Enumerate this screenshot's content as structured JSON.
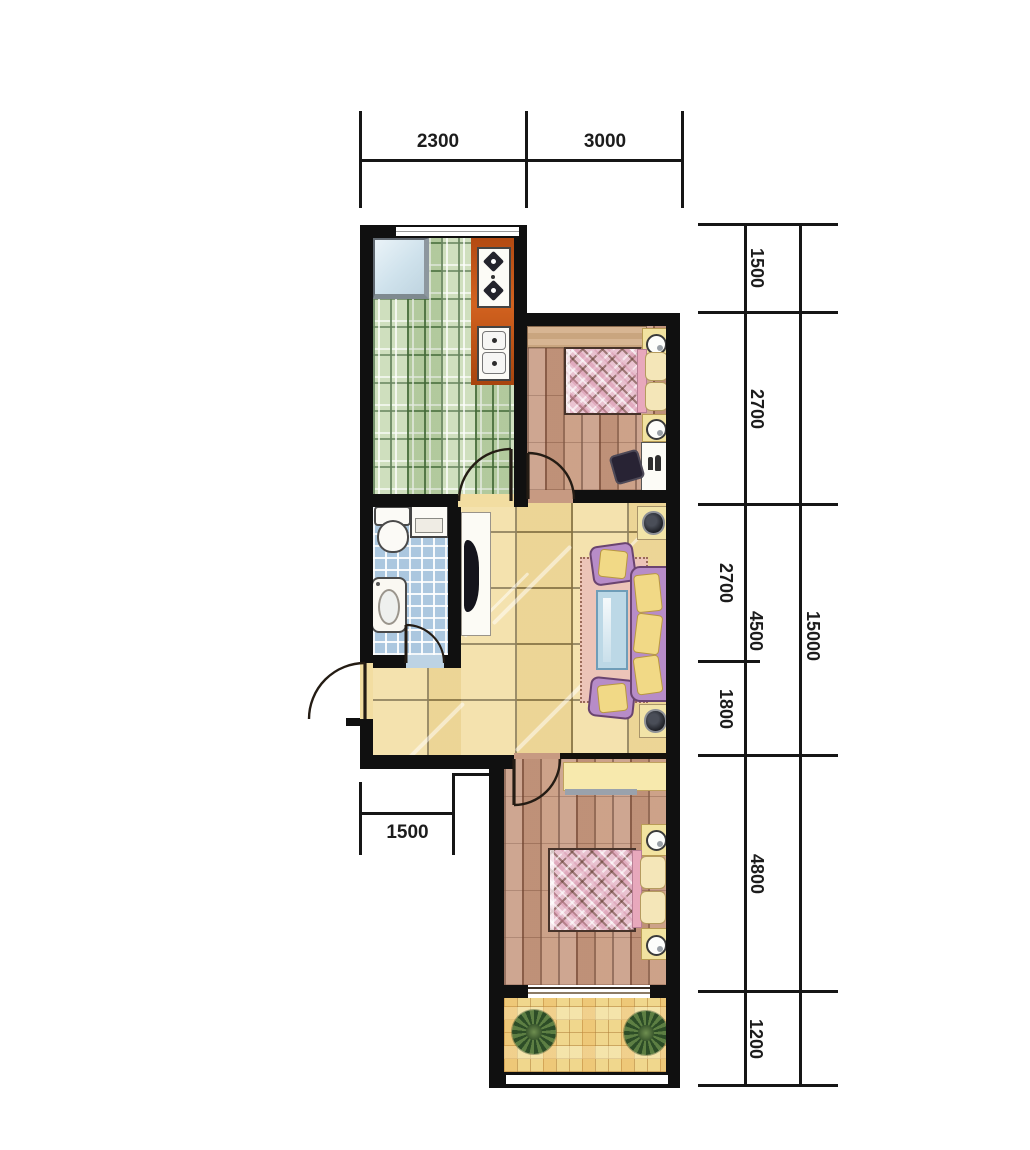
{
  "dimensions": {
    "top": [
      "2300",
      "3000"
    ],
    "right_segments": [
      "1500",
      "2700",
      "2700",
      "1800",
      "4800",
      "1200"
    ],
    "right_subtotal": "4500",
    "right_total": "15000",
    "bottom": "1500"
  },
  "colors": {
    "wall": "#101010",
    "kitchen_floor": "#c3d7ae",
    "bathroom_floor": "#abc7df",
    "living_floor": "#f2dda1",
    "bedroom_floor": "#c79a82",
    "balcony_floor": "#f0d78d",
    "bed_blanket": "#e9c2d0",
    "sofa": "#b78cc8",
    "cushion": "#f1d986",
    "counter": "#c2571a",
    "rug": "#ecc4b8",
    "coffee_table": "#bcd8e6",
    "plant": "#2d4d27"
  }
}
